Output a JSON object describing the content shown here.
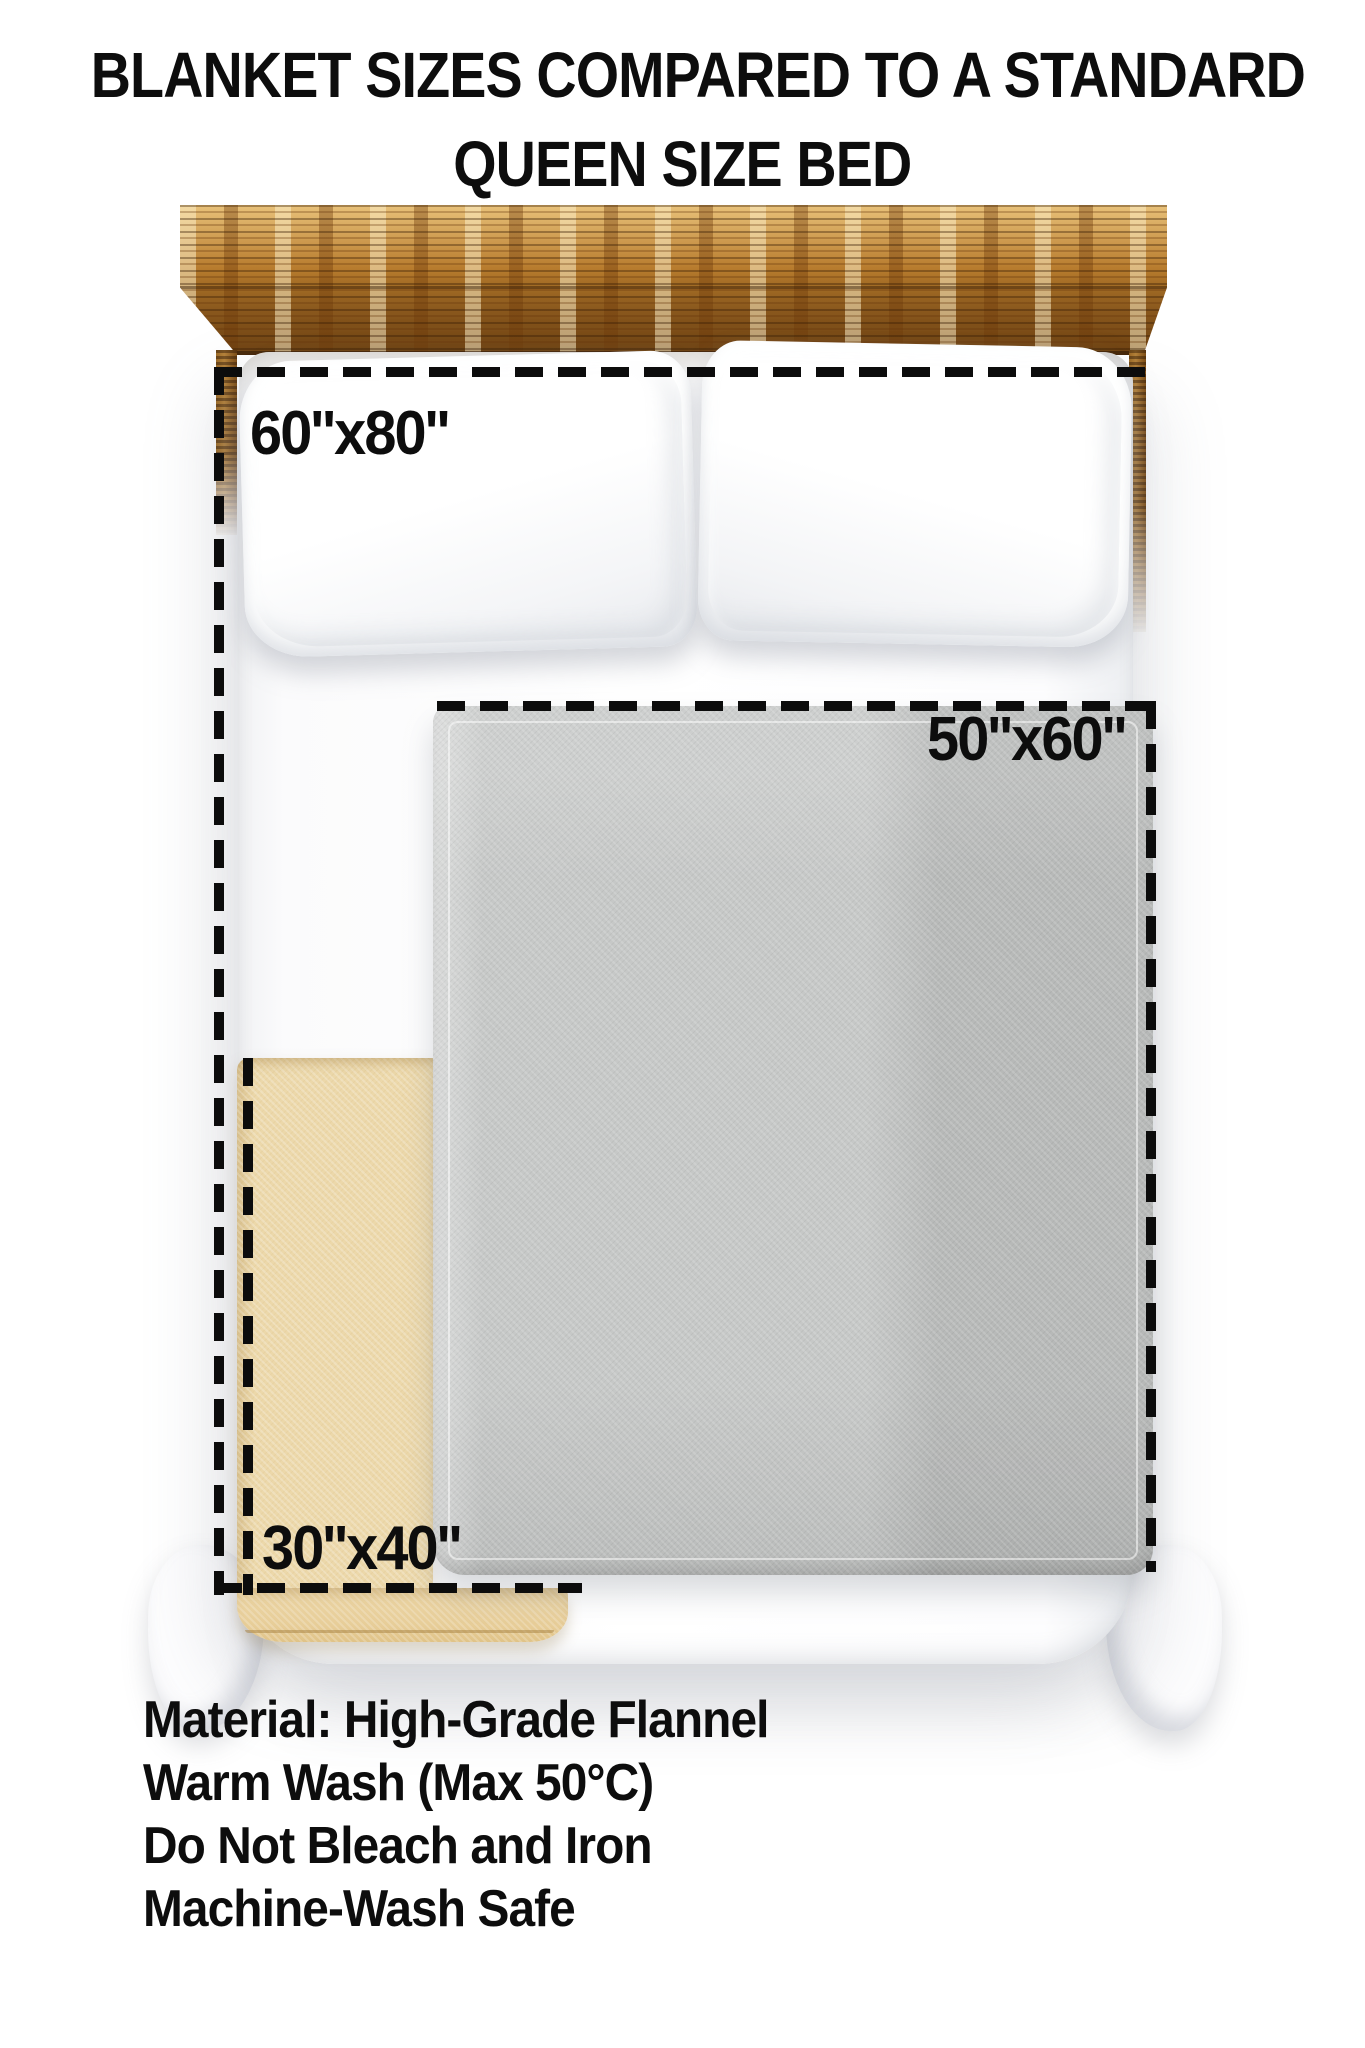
{
  "title": {
    "line1": "BLANKET SIZES COMPARED TO A STANDARD",
    "line2": "QUEEN SIZE BED"
  },
  "blanket_sizes": {
    "large_label": "60''x80''",
    "medium_label": "50''x60''",
    "small_label": "30''x40''"
  },
  "care_instructions": {
    "lines": [
      "Material: High-Grade Flannel",
      "Warm Wash (Max 50°C)",
      "Do Not Bleach and Iron",
      "Machine-Wash Safe"
    ]
  },
  "colors": {
    "page_background": "#ffffff",
    "text": "#0d0d0d",
    "dash": "#0c0c0c",
    "gray_blanket": "#c6c8c7",
    "beige_blanket": "#ecd8aa",
    "wood_light": "#e9c27a",
    "wood_mid": "#b87c2e",
    "wood_dark": "#6e4212"
  }
}
